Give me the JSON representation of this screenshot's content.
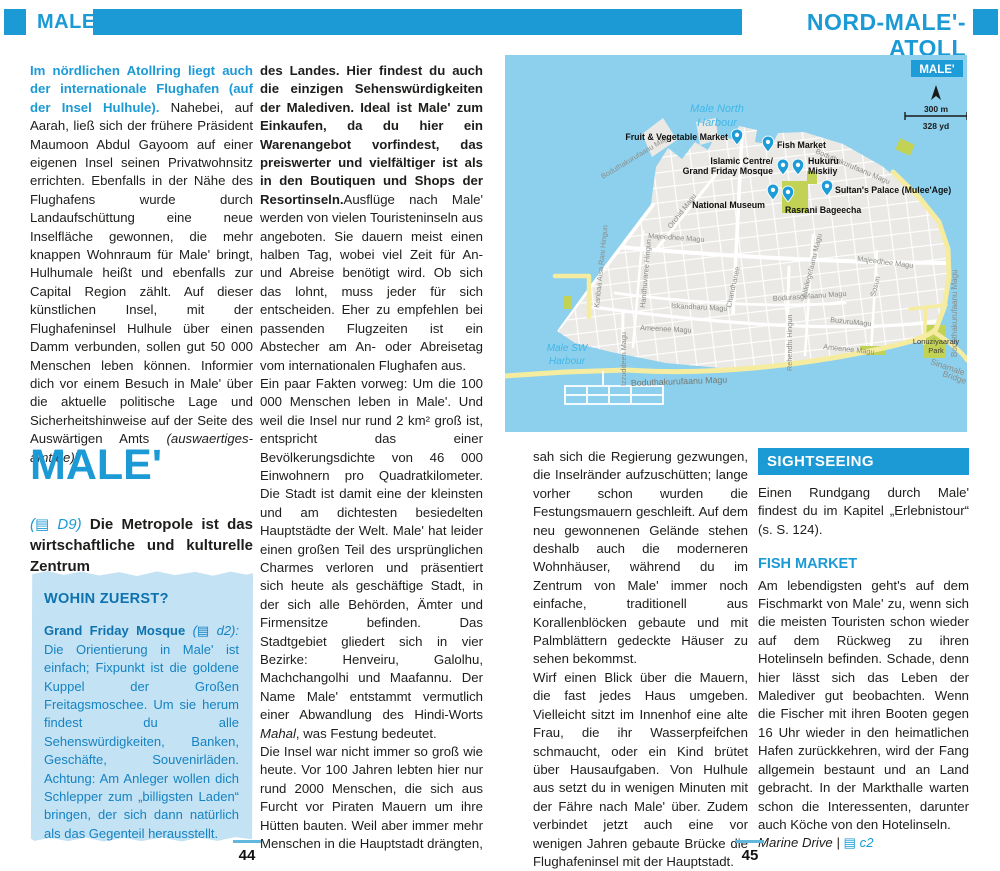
{
  "header": {
    "left_tab": "MALE'",
    "right_title": "NORD-MALE'-ATOLL"
  },
  "col1": {
    "lead_bold": "Im nördlichen Atollring liegt auch der internationale Flughafen (auf der Insel Hulhule).",
    "lead_rest": " Nahebei, auf Aarah, ließ sich der frühere Präsident Maumoon Abdul Gayoom auf einer eigenen Insel seinen Privatwohnsitz errichten. Ebenfalls in der Nähe des Flughafens wurde durch Landaufschüttung eine neue Inselfläche gewonnen, die mehr knappen Wohnraum für Male' bringt, Hulhumale heißt und ebenfalls zur Capital Region zählt. Auf dieser künstlichen Insel, mit der Flughafeninsel Hulhule über einen Damm verbunden, sollen gut 50 000 Menschen leben können. Informier dich vor einem Besuch in Male' über die aktuelle politische Lage und Sicherheitshinweise auf der Seite des Auswärtigen Amts ",
    "lead_site": "(auswaertiges-amt.de)",
    "lead_excl": "!",
    "heading": "MALE'",
    "sub_ref": "(▤ D9) ",
    "sub_text": "Die Metropole ist das wirtschaftliche und kulturelle Zentrum",
    "wohin_title": "WOHIN ZUERST?",
    "wohin_lead": "Grand Friday Mosque ",
    "wohin_ref": "(▤ d2):",
    "wohin_body": " Die Orientierung in Male' ist einfach; Fixpunkt ist die goldene Kuppel der Großen Freitagsmoschee. Um sie herum findest du alle Sehenswürdigkeiten, Banken, Geschäfte, Souvenirläden. Achtung: Am Anleger wollen dich Schlepper zum „billigsten Laden“ bringen, der sich dann natürlich als das Gegenteil herausstellt."
  },
  "col2": {
    "bold": "des Landes. Hier findest du auch die einzigen Sehenswürdigkeiten der Malediven. Ideal ist Male' zum Einkaufen, da du hier ein Warenangebot vorfindest, das preiswerter und vielfältiger ist als in den Boutiquen und Shops der Resortinseln.",
    "p1": "Ausflüge nach Male' werden von vielen Touristeninseln aus angeboten. Sie dauern meist einen halben Tag, wobei viel Zeit für An- und Abreise benötigt wird. Ob sich das lohnt, muss jeder für sich entscheiden. Eher zu empfehlen bei passenden Flugzeiten ist ein Abstecher am An- oder Abreisetag vom internationalen Flughafen aus.",
    "p2a": "Ein paar Fakten vorweg: Um die 100 000 Menschen leben in Male'. Und weil die Insel nur rund 2 km² groß ist, entspricht das einer Bevölkerungsdichte von 46 000 Einwohnern pro Quadratkilometer. Die Stadt ist damit eine der kleinsten und am dichtesten besiedelten Hauptstädte der Welt. Male' hat leider einen großen Teil des ursprünglichen Charmes verloren und präsentiert sich heute als geschäftige Stadt, in der sich alle Behörden, Ämter und Firmensitze befinden. Das Stadtgebiet gliedert sich in vier Bezirke: Henveiru, Galolhu, Machchangolhi und Maafannu. Der Name Male' entstammt vermutlich einer Abwandlung des Hindi-Worts ",
    "p2_italic": "Mahal",
    "p2b": ", was Festung bedeutet.",
    "p3": "Die Insel war nicht immer so groß wie heute. Vor 100 Jahren lebten hier nur rund 2000 Menschen, die sich aus Furcht vor Piraten Mauern um ihre Hütten bauten. Weil aber immer mehr Menschen in die Hauptstadt drängten,"
  },
  "col3": {
    "p1": "sah sich die Regierung gezwungen, die Inselränder aufzuschütten; lange vorher schon wurden die Festungsmauern geschleift. Auf dem neu gewonnenen Gelände stehen deshalb auch die moderneren Wohnhäuser, während du im Zentrum von Male' immer noch einfache, traditionell aus Korallenblöcken gebaute und mit Palmblättern gedeckte Häuser zu sehen bekommst.",
    "p2": "Wirf einen Blick über die Mauern, die fast jedes Haus umgeben. Vielleicht sitzt im Innenhof eine alte Frau, die ihr Wasserpfeifchen schmaucht, oder ein Kind brütet über Hausaufgaben. Von Hulhule aus setzt du in wenigen Minuten mit der Fähre nach Male' über. Zudem verbindet jetzt auch eine vor wenigen Jahren gebaute Brücke die Flughafeninsel mit der Hauptstadt."
  },
  "col4": {
    "sightseeing_title": "SIGHTSEEING",
    "intro": "Einen Rundgang durch Male' findest du im Kapitel „Erlebnistour“ (s. S. 124).",
    "fish_title": "FISH MARKET",
    "fish_body": "Am lebendigsten geht's auf dem Fischmarkt von Male' zu, wenn sich die meisten Touristen schon wieder auf dem Rückweg zu ihren Hotelinseln befinden. Schade, denn hier lässt sich das Leben der Malediver gut beobachten. Wenn die Fischer mit ihren Booten gegen 16 Uhr wieder in den heimatlichen Hafen zurückkehren, wird der Fang allgemein bestaunt und an Land gebracht. In der Markthalle warten schon die Interessenten, darunter auch Köche von den Hotelinseln.",
    "ref_name": "Marine Drive",
    "ref_sep": " | ",
    "ref_map": "▤ c2"
  },
  "map": {
    "title": "MALE'",
    "scale_m": "300 m",
    "scale_yd": "328 yd",
    "harbour_north_1": "Male North",
    "harbour_north_2": "Harbour",
    "harbour_sw_1": "Male SW",
    "harbour_sw_2": "Harbour",
    "pois": {
      "fruit": "Fruit & Vegetable Market",
      "fish": "Fish Market",
      "islamic_1": "Islamic Centre/",
      "islamic_2": "Grand Friday Mosque",
      "hukuru_1": "Hukuru",
      "hukuru_2": "Miskiiy",
      "sultans": "Sultan's Palace (Mulee'Age)",
      "museum": "National Museum",
      "rasrani": "Rasrani Bageecha"
    },
    "streets": {
      "bodu": "Boduthakurufaanu Magu",
      "orchid": "Orchid Magu",
      "majeedhee": "Majeedhee Magu",
      "iskandharu": "Iskandharu Magu",
      "chandhanee": "Chandhanee",
      "bodurasgefaanu": "Bodurasgefaanu Magu",
      "buzuru": "BuzuruMagu",
      "ameenee": "Ameenee Magu",
      "rehendhi": "Rehendhi Hingun",
      "izzuddeen": "Izzuddeen Magu",
      "kanbaa": "Kanbaa Aisa Rani Hingun",
      "handhuvaree": "Handhuvaree Hingun",
      "alikilegefaanu": "Alikilegefaanu Magu",
      "sosun": "Sosun"
    },
    "places": {
      "lonu_1": "Lonuziyaaraiy",
      "lonu_2": "Park",
      "bridge_1": "Sinamale",
      "bridge_2": "Bridge"
    },
    "colors": {
      "sea": "#8cd0ed",
      "land": "#eae9e5",
      "road_major": "#f5eca0",
      "park": "#c1d254",
      "pin": "#1e9cd7"
    }
  },
  "footer": {
    "left_page": "44",
    "right_page": "45"
  }
}
